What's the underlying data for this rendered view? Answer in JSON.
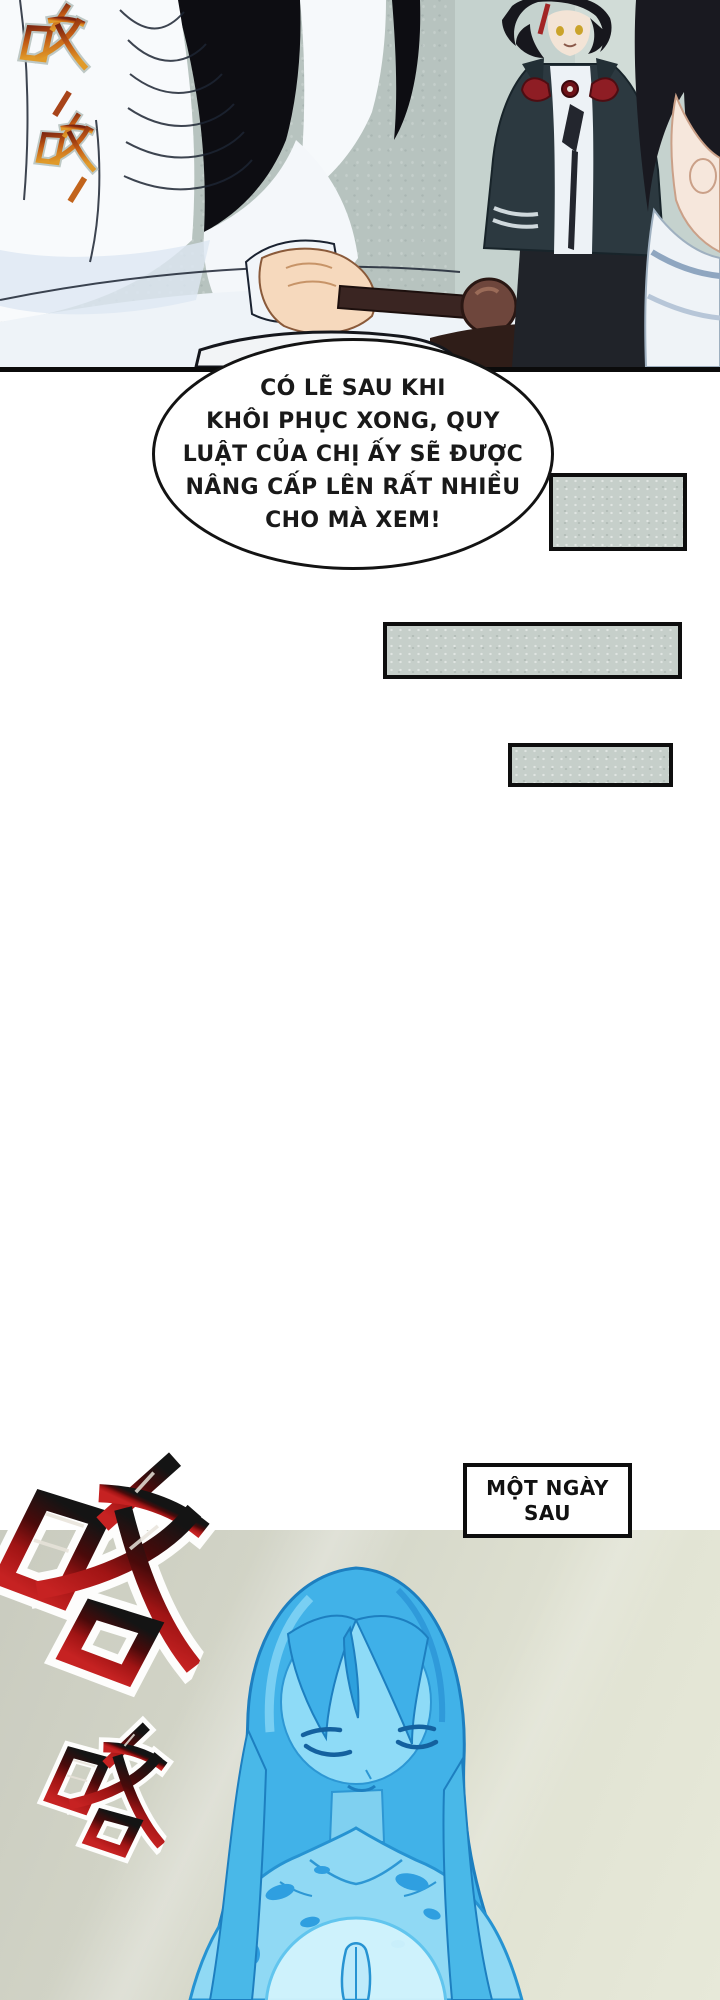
{
  "page": {
    "kind": "manhua-page",
    "background": "#ffffff"
  },
  "panel_top": {
    "description": "white-robed figure grinding with pestle; young man and woman watching",
    "sfx": [
      {
        "text": "呀",
        "style": "orange-red brush glyph"
      },
      {
        "text": "呀",
        "style": "orange brush glyph"
      }
    ]
  },
  "speech_bubble": {
    "lines": [
      "CÓ LẼ SAU KHI",
      "KHÔI PHỤC XONG, QUY",
      "LUẬT CỦA CHỊ ẤY SẼ ĐƯỢC",
      "NÂNG CẤP LÊN RẤT NHIỀU",
      "CHO MÀ XEM!"
    ]
  },
  "caption_box": {
    "line1": "MỘT NGÀY",
    "line2": "SAU"
  },
  "panel_bottom": {
    "description": "blue translucent woman statue with praying hands over glowing chest",
    "sfx": [
      {
        "text": "咯",
        "style": "large black-to-red brush glyph"
      },
      {
        "text": "咯",
        "style": "small black-to-red brush glyph"
      }
    ]
  },
  "colors": {
    "panel_top_bg": "#b7c3bf",
    "tone_bar_fill": "#c6cfca",
    "border_black": "#0e0e0e",
    "panel_bottom_bg_start": "#c9cbbf",
    "panel_bottom_bg_end": "#e7e9d9",
    "sfx_red": "#c02020",
    "sfx_orange": "#d98a24",
    "figure_blue": "#44b4e9",
    "figure_blue_light": "#8edbf7",
    "bowtie_red": "#8e1d24"
  }
}
